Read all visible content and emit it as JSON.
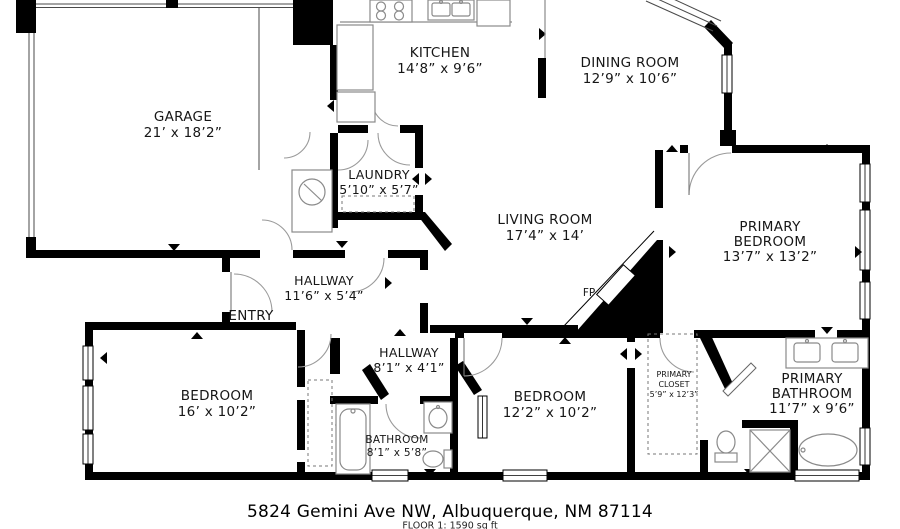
{
  "plan": {
    "address": "5824 Gemini Ave NW, Albuquerque, NM 87114",
    "floor_summary": "FLOOR 1: 1590 sq ft",
    "labels": {
      "entry": "ENTRY",
      "fireplace": "FP"
    },
    "colors": {
      "walls": "#000000",
      "text": "#161616",
      "fixture_lines": "#8a8a8a"
    },
    "rooms": {
      "garage": {
        "name": "GARAGE",
        "dims": "21’ x 18’2”"
      },
      "kitchen": {
        "name": "KITCHEN",
        "dims": "14’8” x 9’6”"
      },
      "dining_room": {
        "name": "DINING ROOM",
        "dims": "12’9” x 10’6”"
      },
      "laundry": {
        "name": "LAUNDRY",
        "dims": "5’10” x 5’7”"
      },
      "living_room": {
        "name": "LIVING ROOM",
        "dims": "17’4” x 14’"
      },
      "primary_bedroom": {
        "name_line1": "PRIMARY",
        "name_line2": "BEDROOM",
        "dims": "13’7” x 13’2”"
      },
      "hallway_upper": {
        "name": "HALLWAY",
        "dims": "11’6” x 5’4”"
      },
      "hallway_lower": {
        "name": "HALLWAY",
        "dims": "8’1” x 4’1”"
      },
      "bedroom_left": {
        "name": "BEDROOM",
        "dims": "16’ x 10’2”"
      },
      "bathroom": {
        "name": "BATHROOM",
        "dims": "8’1” x 5’8”"
      },
      "bedroom_middle": {
        "name": "BEDROOM",
        "dims": "12’2” x 10’2”"
      },
      "primary_closet": {
        "name_line1": "PRIMARY",
        "name_line2": "CLOSET",
        "dims": "5’9” x 12’3”"
      },
      "primary_bathroom": {
        "name_line1": "PRIMARY",
        "name_line2": "BATHROOM",
        "dims": "11’7” x 9’6”"
      }
    },
    "fixture_icons": [
      "stove-icon",
      "kitchen-sink-icon",
      "refrigerator-icon",
      "water-heater-icon",
      "washer-dryer-area",
      "bathtub-icon",
      "toilet-icon",
      "bathroom-sink-icon",
      "shower-icon",
      "double-vanity-icon",
      "soaking-tub-icon",
      "fireplace-icon"
    ]
  }
}
